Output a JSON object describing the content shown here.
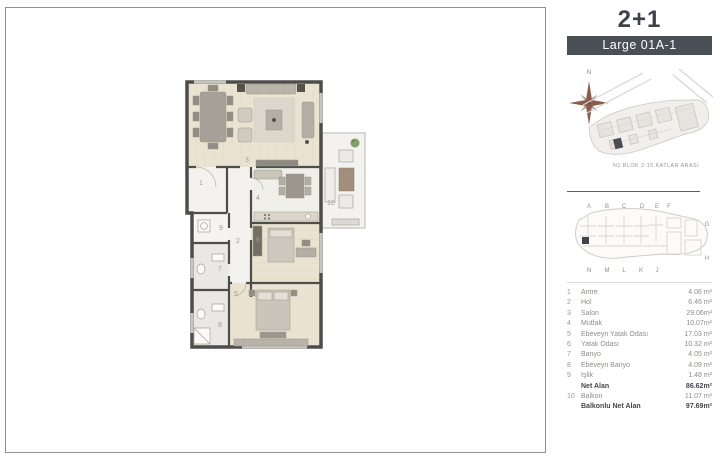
{
  "header": {
    "title": "2+1",
    "variant": "Large 01A-1"
  },
  "site_plan": {
    "north_label": "N",
    "caption": "N1 BLOK 2-15.KATLAR ARASI"
  },
  "key_plan": {
    "top_letters": [
      "A",
      "B",
      "C",
      "D",
      "E",
      "F"
    ],
    "right_letters": [
      "G",
      "H"
    ],
    "bottom_letters": [
      "N",
      "M",
      "L",
      "K",
      "J"
    ]
  },
  "plan_labels": {
    "antre": "1",
    "hol": "2",
    "salon": "3",
    "mutfak": "4",
    "ebeveyn_yatak": "5",
    "yatak": "6",
    "banyo": "7",
    "ebeveyn_banyo": "8",
    "islik": "9",
    "balkon": "10"
  },
  "area_list": {
    "rows": [
      {
        "no": "1",
        "label": "Antre",
        "value": "4.06 m²"
      },
      {
        "no": "2",
        "label": "Hol",
        "value": "6.46 m²"
      },
      {
        "no": "3",
        "label": "Salon",
        "value": "29.06m²"
      },
      {
        "no": "4",
        "label": "Mutfak",
        "value": "10.07m²"
      },
      {
        "no": "5",
        "label": "Ebeveyn Yatak Odası",
        "value": "17.03 m²"
      },
      {
        "no": "6",
        "label": "Yatak Odası",
        "value": "10.32 m²"
      },
      {
        "no": "7",
        "label": "Banyo",
        "value": "4.05 m²"
      },
      {
        "no": "8",
        "label": "Ebeveyn Banyo",
        "value": "4.09 m²"
      },
      {
        "no": "9",
        "label": "Işlik",
        "value": "1.48 m²"
      },
      {
        "no": "",
        "label": "Net Alan",
        "value": "86.62m²"
      },
      {
        "no": "10",
        "label": "Balkon",
        "value": "11.07 m²"
      },
      {
        "no": "",
        "label": "Balkonlu Net Alan",
        "value": "97.69m²"
      }
    ]
  },
  "gross_area": {
    "label": "SATIŞA ESAS BRÜT ALANI",
    "value": "141.65m²"
  },
  "colors": {
    "accent_dark": "#4a4e55",
    "wall": "#4f4d4a",
    "wood_floor": "#eae3d2",
    "tile_floor": "#e9e8e5",
    "compass_rose": "#8a5c4c",
    "plant_green": "#82a065",
    "key_highlight": "#3f434a"
  }
}
